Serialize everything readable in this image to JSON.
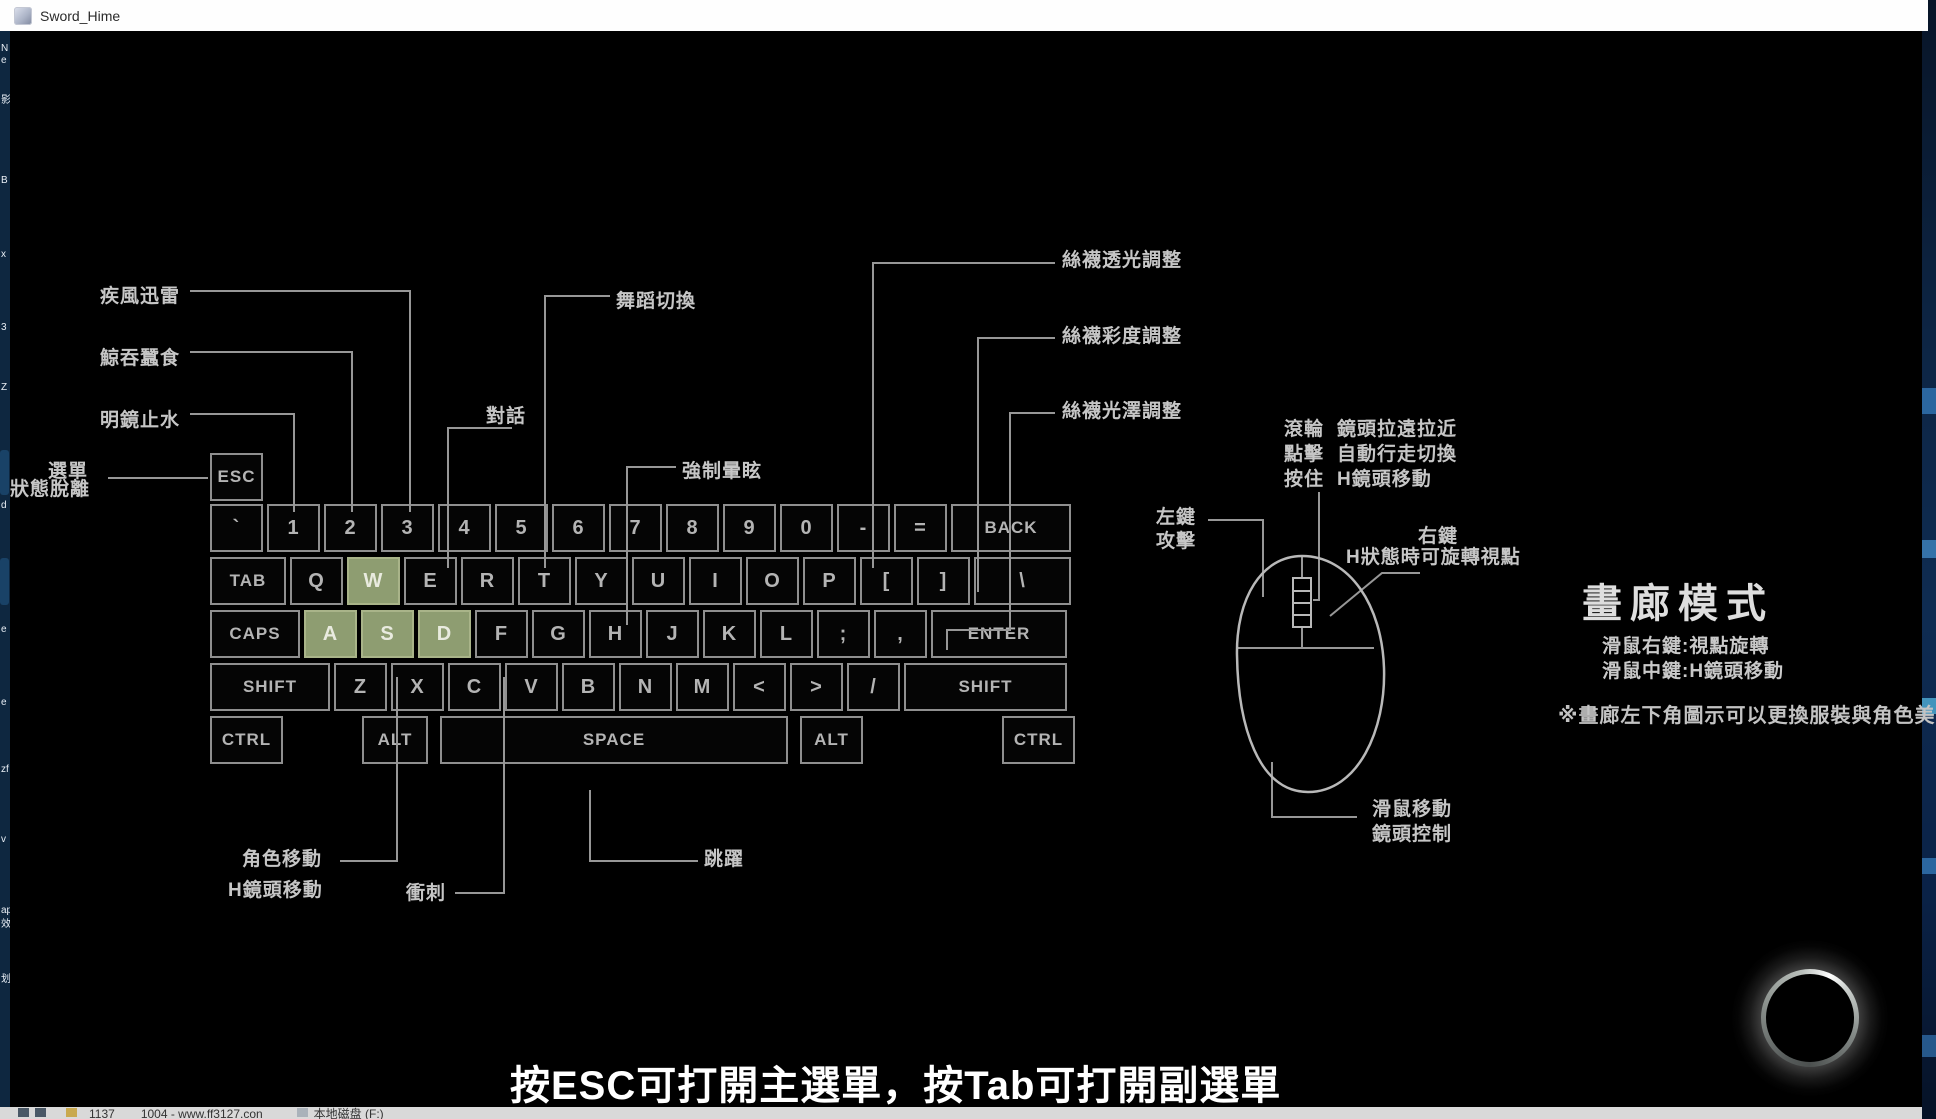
{
  "window": {
    "title": "Sword_Hime",
    "close_glyph": "✕"
  },
  "keyboard": {
    "rows": [
      [
        {
          "label": "ESC",
          "w": 53,
          "small": true
        }
      ],
      [
        {
          "label": "`",
          "w": 53
        },
        {
          "label": "1",
          "w": 53
        },
        {
          "label": "2",
          "w": 53
        },
        {
          "label": "3",
          "w": 53
        },
        {
          "label": "4",
          "w": 53
        },
        {
          "label": "5",
          "w": 53
        },
        {
          "label": "6",
          "w": 53
        },
        {
          "label": "7",
          "w": 53
        },
        {
          "label": "8",
          "w": 53
        },
        {
          "label": "9",
          "w": 53
        },
        {
          "label": "0",
          "w": 53
        },
        {
          "label": "-",
          "w": 53
        },
        {
          "label": "=",
          "w": 53
        },
        {
          "label": "BACK",
          "w": 120,
          "small": true
        }
      ],
      [
        {
          "label": "TAB",
          "w": 76,
          "small": true
        },
        {
          "label": "Q",
          "w": 53
        },
        {
          "label": "W",
          "w": 53,
          "hl": true
        },
        {
          "label": "E",
          "w": 53
        },
        {
          "label": "R",
          "w": 53
        },
        {
          "label": "T",
          "w": 53
        },
        {
          "label": "Y",
          "w": 53
        },
        {
          "label": "U",
          "w": 53
        },
        {
          "label": "I",
          "w": 53
        },
        {
          "label": "O",
          "w": 53
        },
        {
          "label": "P",
          "w": 53
        },
        {
          "label": "[",
          "w": 53
        },
        {
          "label": "]",
          "w": 53
        },
        {
          "label": "\\",
          "w": 97
        }
      ],
      [
        {
          "label": "CAPS",
          "w": 90,
          "small": true
        },
        {
          "label": "A",
          "w": 53,
          "hl": true
        },
        {
          "label": "S",
          "w": 53,
          "hl": true
        },
        {
          "label": "D",
          "w": 53,
          "hl": true
        },
        {
          "label": "F",
          "w": 53
        },
        {
          "label": "G",
          "w": 53
        },
        {
          "label": "H",
          "w": 53
        },
        {
          "label": "J",
          "w": 53
        },
        {
          "label": "K",
          "w": 53
        },
        {
          "label": "L",
          "w": 53
        },
        {
          "label": ";",
          "w": 53
        },
        {
          "label": ",",
          "w": 53
        },
        {
          "label": "ENTER",
          "w": 136,
          "small": true
        }
      ],
      [
        {
          "label": "SHIFT",
          "w": 120,
          "small": true
        },
        {
          "label": "Z",
          "w": 53
        },
        {
          "label": "X",
          "w": 53
        },
        {
          "label": "C",
          "w": 53
        },
        {
          "label": "V",
          "w": 53
        },
        {
          "label": "B",
          "w": 53
        },
        {
          "label": "N",
          "w": 53
        },
        {
          "label": "M",
          "w": 53
        },
        {
          "label": "<",
          "w": 53
        },
        {
          "label": ">",
          "w": 53
        },
        {
          "label": "/",
          "w": 53
        },
        {
          "label": "SHIFT",
          "w": 163,
          "small": true
        }
      ],
      [
        {
          "label": "CTRL",
          "w": 73,
          "small": true
        },
        {
          "sp": 71
        },
        {
          "label": "ALT",
          "w": 66,
          "small": true
        },
        {
          "sp": 4
        },
        {
          "label": "SPACE",
          "w": 348,
          "small": true
        },
        {
          "sp": 4
        },
        {
          "label": "ALT",
          "w": 63,
          "small": true
        },
        {
          "sp": 131
        },
        {
          "label": "CTRL",
          "w": 73,
          "small": true
        }
      ]
    ]
  },
  "annotations": [
    {
      "text": "疾風迅雷",
      "x": 100,
      "y": 281
    },
    {
      "text": "鯨吞蠶食",
      "x": 100,
      "y": 343
    },
    {
      "text": "明鏡止水",
      "x": 100,
      "y": 405
    },
    {
      "text": "選單",
      "x": 48,
      "y": 456
    },
    {
      "text": "狀態脫離",
      "x": 10,
      "y": 474
    },
    {
      "text": "對話",
      "x": 486,
      "y": 401
    },
    {
      "text": "舞蹈切換",
      "x": 616,
      "y": 286
    },
    {
      "text": "強制暈眩",
      "x": 682,
      "y": 456
    },
    {
      "text": "絲襪透光調整",
      "x": 1062,
      "y": 245
    },
    {
      "text": "絲襪彩度調整",
      "x": 1062,
      "y": 321
    },
    {
      "text": "絲襪光澤調整",
      "x": 1062,
      "y": 396
    },
    {
      "text": "角色移動",
      "x": 242,
      "y": 844
    },
    {
      "text": "H鏡頭移動",
      "x": 228,
      "y": 875
    },
    {
      "text": "衝刺",
      "x": 406,
      "y": 878
    },
    {
      "text": "跳躍",
      "x": 704,
      "y": 844
    },
    {
      "text": "左鍵",
      "x": 1156,
      "y": 502
    },
    {
      "text": "攻擊",
      "x": 1156,
      "y": 526
    },
    {
      "text": "右鍵",
      "x": 1418,
      "y": 521
    },
    {
      "text": "H狀態時可旋轉視點",
      "x": 1346,
      "y": 542
    },
    {
      "text": "滾輪",
      "x": 1284,
      "y": 414
    },
    {
      "text": "鏡頭拉遠拉近",
      "x": 1337,
      "y": 414
    },
    {
      "text": "點擊",
      "x": 1284,
      "y": 439
    },
    {
      "text": "自動行走切換",
      "x": 1337,
      "y": 439
    },
    {
      "text": "按住",
      "x": 1284,
      "y": 464
    },
    {
      "text": "H鏡頭移動",
      "x": 1337,
      "y": 464
    },
    {
      "text": "滑鼠移動",
      "x": 1372,
      "y": 794
    },
    {
      "text": "鏡頭控制",
      "x": 1372,
      "y": 819
    }
  ],
  "gallery": {
    "title": "畫廊模式",
    "line1": "滑鼠右鍵:視點旋轉",
    "line2": "滑鼠中鍵:H鏡頭移動",
    "note": "※畫廊左下角圖示可以更換服裝與角色美體"
  },
  "subtitle": "按ESC可打開主選單，按Tab可打開副選單",
  "wires": [
    [
      [
        190,
        291
      ],
      [
        410,
        291
      ],
      [
        410,
        512
      ]
    ],
    [
      [
        190,
        352
      ],
      [
        352,
        352
      ],
      [
        352,
        512
      ]
    ],
    [
      [
        190,
        414
      ],
      [
        294,
        414
      ],
      [
        294,
        512
      ]
    ],
    [
      [
        108,
        478
      ],
      [
        208,
        478
      ]
    ],
    [
      [
        512,
        428
      ],
      [
        448,
        428
      ],
      [
        448,
        568
      ]
    ],
    [
      [
        610,
        296
      ],
      [
        545,
        296
      ],
      [
        545,
        568
      ]
    ],
    [
      [
        676,
        467
      ],
      [
        627,
        467
      ],
      [
        627,
        625
      ]
    ],
    [
      [
        1055,
        263
      ],
      [
        873,
        263
      ],
      [
        873,
        568
      ]
    ],
    [
      [
        1055,
        338
      ],
      [
        978,
        338
      ],
      [
        978,
        592
      ]
    ],
    [
      [
        1055,
        413
      ],
      [
        1010,
        413
      ],
      [
        1010,
        630
      ],
      [
        947,
        630
      ],
      [
        947,
        650
      ]
    ],
    [
      [
        340,
        861
      ],
      [
        397,
        861
      ],
      [
        397,
        677
      ]
    ],
    [
      [
        455,
        893
      ],
      [
        504,
        893
      ],
      [
        504,
        677
      ]
    ],
    [
      [
        698,
        861
      ],
      [
        590,
        861
      ],
      [
        590,
        790
      ]
    ],
    [
      [
        1208,
        520
      ],
      [
        1263,
        520
      ],
      [
        1263,
        597
      ]
    ],
    [
      [
        1420,
        573
      ],
      [
        1382,
        573
      ],
      [
        1330,
        616
      ]
    ],
    [
      [
        1319,
        492
      ],
      [
        1319,
        600
      ],
      [
        1313,
        600
      ]
    ],
    [
      [
        1272,
        762
      ],
      [
        1272,
        817
      ],
      [
        1357,
        817
      ]
    ],
    [
      [
        1237,
        648
      ],
      [
        1374,
        648
      ]
    ],
    [
      [
        1302,
        557
      ],
      [
        1302,
        578
      ]
    ],
    [
      [
        1302,
        627
      ],
      [
        1302,
        648
      ]
    ]
  ],
  "mouse": {
    "body_path": "M 1302 556 C 1262 556 1236 598 1237 655 C 1238 725 1258 792 1308 792 C 1358 792 1386 730 1384 668 C 1382 606 1350 556 1302 556 Z",
    "wheel": {
      "x": 1293,
      "y": 578,
      "w": 18,
      "h": 49,
      "segments": [
        591,
        603,
        615
      ]
    }
  },
  "desktop_fragments": [
    {
      "text": "N",
      "y": 44
    },
    {
      "text": "e",
      "y": 56
    },
    {
      "text": "影",
      "y": 96
    },
    {
      "text": "B",
      "y": 176
    },
    {
      "text": "x",
      "y": 250
    },
    {
      "text": "3",
      "y": 323
    },
    {
      "text": "Z",
      "y": 383
    },
    {
      "text": "d",
      "y": 501
    },
    {
      "text": "e",
      "y": 625
    },
    {
      "text": "e",
      "y": 698
    },
    {
      "text": "zf",
      "y": 765
    },
    {
      "text": "v",
      "y": 835
    },
    {
      "text": "ap",
      "y": 906
    },
    {
      "text": "效",
      "y": 920
    },
    {
      "text": "划",
      "y": 975
    }
  ],
  "taskbar": {
    "link": "1137",
    "title": "1004 - www.ff3127.con",
    "drive": "本地磁盘 (F:)"
  },
  "colors": {
    "wire": "#979797",
    "mouse_stroke": "#b9b9b9",
    "key_green": "#8e9d71"
  }
}
